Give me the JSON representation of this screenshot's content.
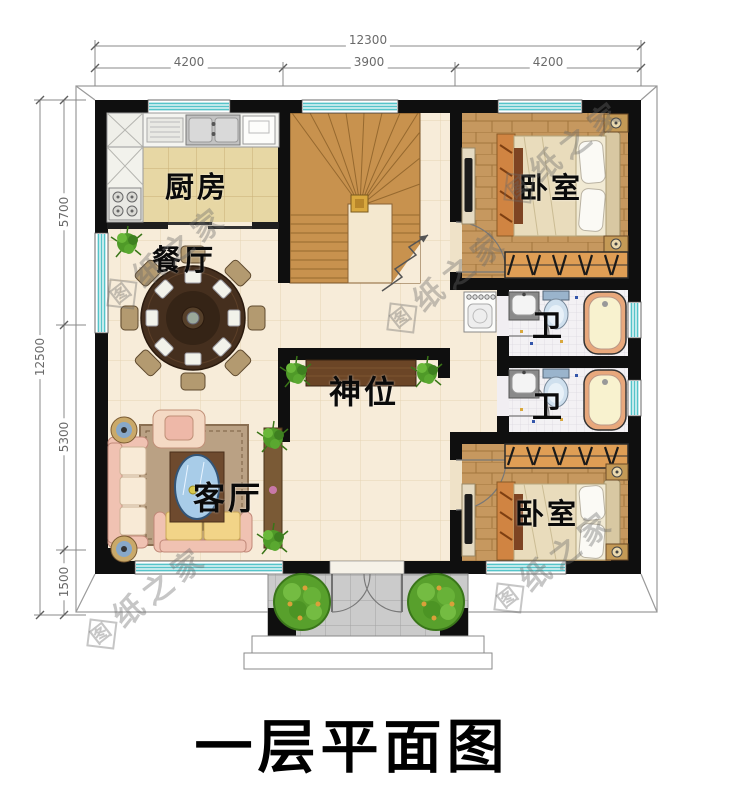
{
  "title": "一层平面图",
  "watermark": {
    "logo": "图",
    "text": "纸之家"
  },
  "rooms": {
    "kitchen": "厨房",
    "dining": "餐厅",
    "bedroom_top": "卧室",
    "bathroom_top": "卫",
    "bathroom_bottom": "卫",
    "shrine": "神位",
    "living": "客厅",
    "bedroom_bottom": "卧室"
  },
  "dimensions": {
    "top_total": "12300",
    "top_segments": [
      "4200",
      "3900",
      "4200"
    ],
    "left_total": "12500",
    "left_segments": [
      "5700",
      "5300",
      "1500"
    ]
  }
}
